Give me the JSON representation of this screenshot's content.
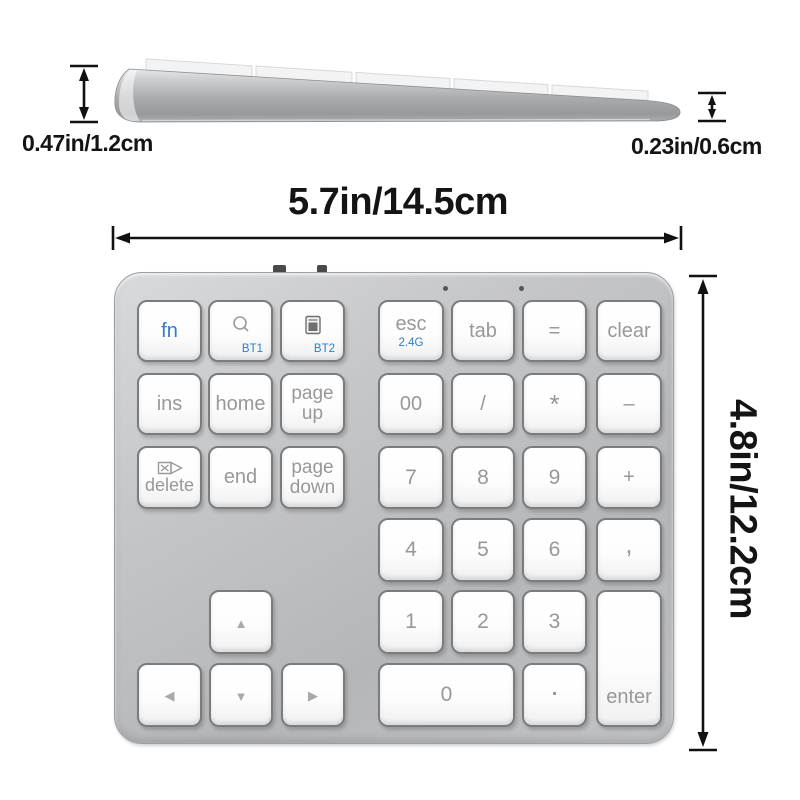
{
  "product": {
    "type": "wireless-numeric-keypad-product-image"
  },
  "labels": {
    "width": "5.7in/14.5cm",
    "height": "4.8in/12.2cm",
    "left_height": "0.47in/1.2cm",
    "right_height": "0.23in/0.6cm"
  },
  "colors": {
    "accent_blue": "#2f7dca",
    "key_text_gray": "#97989a",
    "dimension_text": "#141414",
    "body_silver": "#bfc0c2",
    "key_white": "#fdfdfd"
  },
  "indicators": {
    "led_dots": 2,
    "top_edge_ports": 2
  },
  "keypad": {
    "keys": [
      {
        "name": "fn",
        "label": "fn",
        "style": "fn",
        "x": 137,
        "y": 300,
        "w": 65,
        "h": 62
      },
      {
        "name": "bt1",
        "icon": "search",
        "sub": "BT1",
        "style": "bt",
        "x": 208,
        "y": 300,
        "w": 65,
        "h": 62
      },
      {
        "name": "bt2",
        "icon": "calc",
        "sub": "BT2",
        "style": "bt",
        "x": 280,
        "y": 300,
        "w": 65,
        "h": 62
      },
      {
        "name": "esc",
        "label": "esc",
        "sub": "2.4G",
        "style": "esc",
        "x": 378,
        "y": 300,
        "w": 66,
        "h": 62
      },
      {
        "name": "tab",
        "label": "tab",
        "x": 451,
        "y": 300,
        "w": 64,
        "h": 62
      },
      {
        "name": "equals",
        "label": "=",
        "x": 522,
        "y": 300,
        "w": 65,
        "h": 62
      },
      {
        "name": "clear",
        "label": "clear",
        "x": 596,
        "y": 300,
        "w": 66,
        "h": 62
      },
      {
        "name": "ins",
        "label": "ins",
        "x": 137,
        "y": 373,
        "w": 65,
        "h": 62
      },
      {
        "name": "home",
        "label": "home",
        "x": 208,
        "y": 373,
        "w": 65,
        "h": 62
      },
      {
        "name": "page-up",
        "label": "page up",
        "style": "twoline",
        "x": 280,
        "y": 373,
        "w": 65,
        "h": 62
      },
      {
        "name": "double-zero",
        "label": "00",
        "x": 378,
        "y": 373,
        "w": 66,
        "h": 62
      },
      {
        "name": "divide",
        "label": "/",
        "x": 451,
        "y": 373,
        "w": 64,
        "h": 62
      },
      {
        "name": "multiply",
        "label": "*",
        "style": "star",
        "x": 522,
        "y": 373,
        "w": 65,
        "h": 62
      },
      {
        "name": "minus",
        "label": "–",
        "x": 596,
        "y": 373,
        "w": 66,
        "h": 62
      },
      {
        "name": "delete",
        "label": "delete",
        "icon": "del",
        "style": "delete",
        "x": 137,
        "y": 446,
        "w": 65,
        "h": 63
      },
      {
        "name": "end",
        "label": "end",
        "x": 208,
        "y": 446,
        "w": 65,
        "h": 63
      },
      {
        "name": "page-down",
        "label": "page down",
        "style": "twoline",
        "x": 280,
        "y": 446,
        "w": 65,
        "h": 63
      },
      {
        "name": "num-7",
        "label": "7",
        "style": "num",
        "x": 378,
        "y": 446,
        "w": 66,
        "h": 63
      },
      {
        "name": "num-8",
        "label": "8",
        "style": "num",
        "x": 451,
        "y": 446,
        "w": 64,
        "h": 63
      },
      {
        "name": "num-9",
        "label": "9",
        "style": "num",
        "x": 522,
        "y": 446,
        "w": 65,
        "h": 63
      },
      {
        "name": "plus",
        "label": "+",
        "x": 596,
        "y": 446,
        "w": 66,
        "h": 63
      },
      {
        "name": "num-4",
        "label": "4",
        "style": "num",
        "x": 378,
        "y": 518,
        "w": 66,
        "h": 64
      },
      {
        "name": "num-5",
        "label": "5",
        "style": "num",
        "x": 451,
        "y": 518,
        "w": 64,
        "h": 64
      },
      {
        "name": "num-6",
        "label": "6",
        "style": "num",
        "x": 522,
        "y": 518,
        "w": 65,
        "h": 64
      },
      {
        "name": "comma",
        "label": ",",
        "style": "comma",
        "x": 596,
        "y": 518,
        "w": 66,
        "h": 64
      },
      {
        "name": "arrow-up",
        "glyph": "▲",
        "style": "arrow",
        "x": 209,
        "y": 590,
        "w": 64,
        "h": 64
      },
      {
        "name": "num-1",
        "label": "1",
        "style": "num",
        "x": 378,
        "y": 590,
        "w": 66,
        "h": 64
      },
      {
        "name": "num-2",
        "label": "2",
        "style": "num",
        "x": 451,
        "y": 590,
        "w": 64,
        "h": 64
      },
      {
        "name": "num-3",
        "label": "3",
        "style": "num",
        "x": 522,
        "y": 590,
        "w": 65,
        "h": 64
      },
      {
        "name": "enter",
        "label": "enter",
        "style": "enter",
        "x": 596,
        "y": 590,
        "w": 66,
        "h": 137
      },
      {
        "name": "arrow-left",
        "glyph": "◀",
        "style": "arrow",
        "x": 137,
        "y": 663,
        "w": 65,
        "h": 64
      },
      {
        "name": "arrow-down",
        "glyph": "▼",
        "style": "arrow",
        "x": 209,
        "y": 663,
        "w": 64,
        "h": 64
      },
      {
        "name": "arrow-right",
        "glyph": "▶",
        "style": "arrow",
        "x": 281,
        "y": 663,
        "w": 64,
        "h": 64
      },
      {
        "name": "num-0",
        "label": "0",
        "style": "num",
        "x": 378,
        "y": 663,
        "w": 137,
        "h": 64
      },
      {
        "name": "decimal",
        "label": ".",
        "style": "dot",
        "x": 522,
        "y": 663,
        "w": 65,
        "h": 64
      }
    ]
  }
}
